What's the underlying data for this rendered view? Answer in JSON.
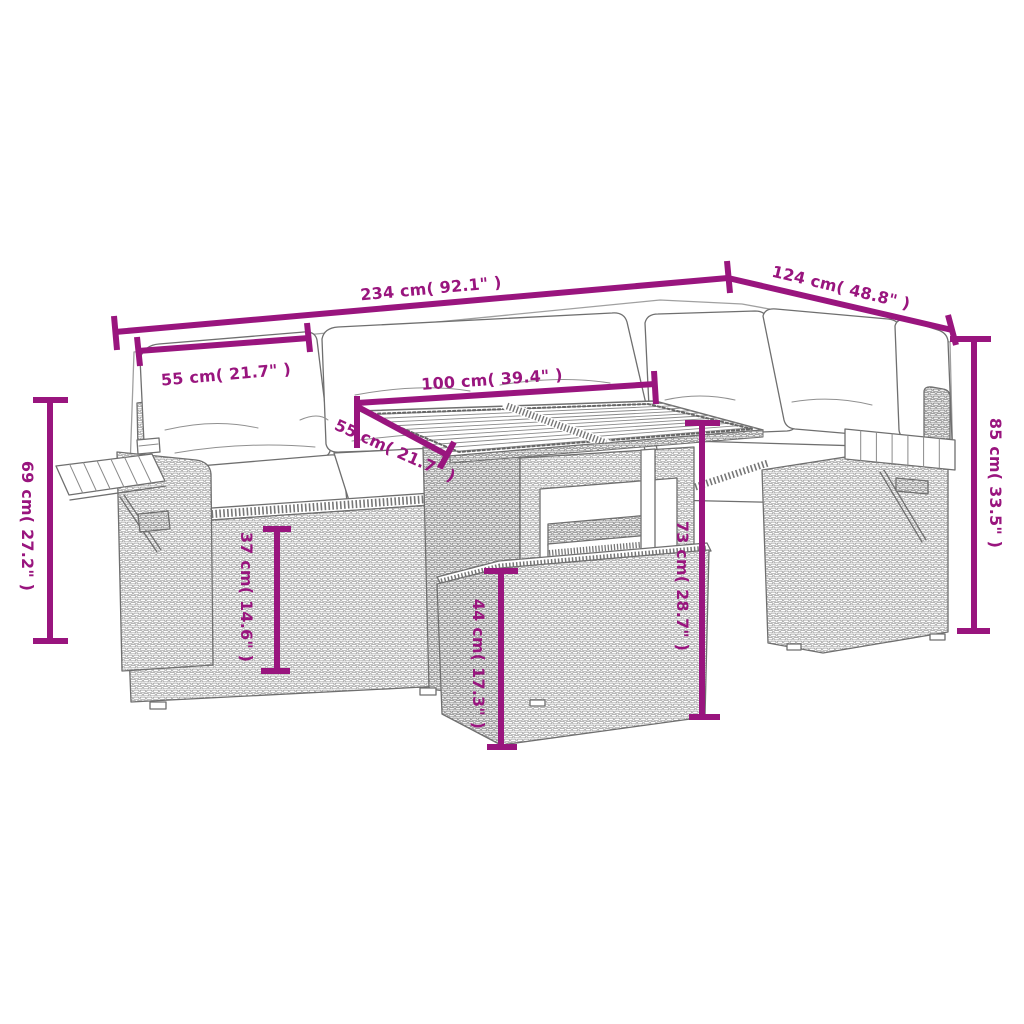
{
  "accent_color": "#99157E",
  "artwork": {
    "subject": "garden furniture set line drawing",
    "pieces": [
      "corner sofa with cushions",
      "fold-out armrest trays",
      "slatted-top table with under-table bench",
      "footstool"
    ]
  },
  "dimensions": [
    {
      "id": "overall-length",
      "label": "234 cm( 92.1\" )"
    },
    {
      "id": "overall-depth",
      "label": "124 cm( 48.8\" )"
    },
    {
      "id": "back-height",
      "label": "85 cm( 33.5\" )"
    },
    {
      "id": "armrest-tray-height",
      "label": "69 cm( 27.2\" )"
    },
    {
      "id": "back-cushion-width",
      "label": "55 cm( 21.7\" )"
    },
    {
      "id": "table-top-length",
      "label": "100 cm( 39.4\" )"
    },
    {
      "id": "table-top-depth",
      "label": "55 cm( 21.7\" )"
    },
    {
      "id": "table-height",
      "label": "73 cm( 28.7\" )"
    },
    {
      "id": "footstool-height",
      "label": "44 cm( 17.3\" )"
    },
    {
      "id": "seat-height",
      "label": "37 cm( 14.6\" )"
    }
  ]
}
